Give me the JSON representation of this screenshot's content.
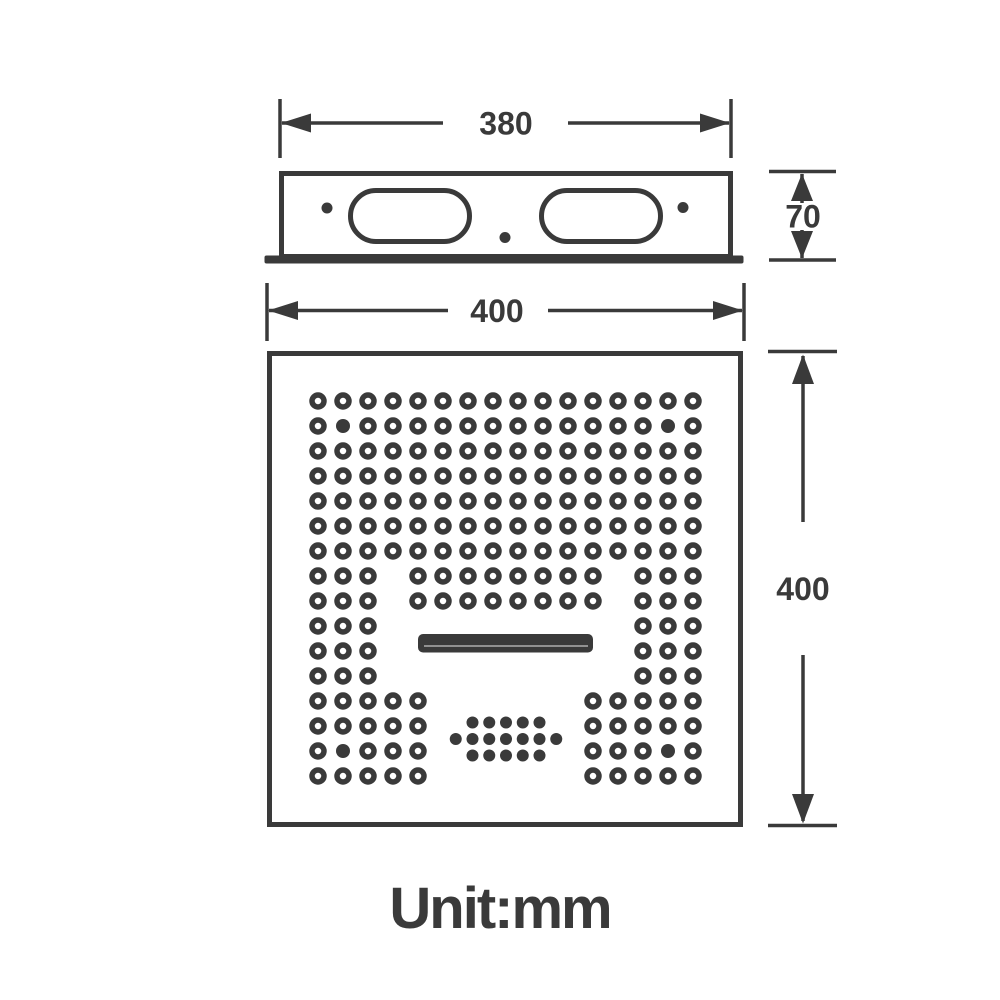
{
  "colors": {
    "ink": "#3a3a3a",
    "background": "#ffffff",
    "waterfall_highlight": "#9e9e9e"
  },
  "dimension_labels": {
    "body_width": "380",
    "body_height": "70",
    "panel_width": "400",
    "panel_height": "400"
  },
  "unit_label": "Unit:mm",
  "front_view": {
    "nozzle_grid": {
      "origin": [
        318,
        401
      ],
      "spacing": 25,
      "dot_radius": 6,
      "ring_width": 5.5,
      "solid_radius": 7,
      "rows": [
        [
          [
            1,
            16
          ]
        ],
        [
          [
            1,
            16
          ]
        ],
        [
          [
            1,
            16
          ]
        ],
        [
          [
            1,
            16
          ]
        ],
        [
          [
            1,
            16
          ]
        ],
        [
          [
            1,
            16
          ]
        ],
        [
          [
            1,
            16
          ]
        ],
        [
          [
            1,
            3
          ],
          [
            5,
            12
          ],
          [
            14,
            16
          ]
        ],
        [
          [
            1,
            3
          ],
          [
            5,
            12
          ],
          [
            14,
            16
          ]
        ],
        [
          [
            1,
            3
          ],
          [
            14,
            16
          ]
        ],
        [
          [
            1,
            3
          ],
          [
            14,
            16
          ]
        ],
        [
          [
            1,
            3
          ],
          [
            14,
            16
          ]
        ],
        [
          [
            1,
            5
          ],
          [
            12,
            16
          ]
        ],
        [
          [
            1,
            5
          ],
          [
            12,
            16
          ]
        ],
        [
          [
            1,
            5
          ],
          [
            12,
            16
          ]
        ],
        [
          [
            1,
            5
          ],
          [
            12,
            16
          ]
        ]
      ],
      "solid_dots": [
        [
          2,
          2
        ],
        [
          2,
          15
        ],
        [
          15,
          2
        ],
        [
          15,
          15
        ]
      ]
    },
    "mist_cluster": {
      "center": [
        506,
        739
      ],
      "col_spacing": 16.75,
      "row_spacing": 16.5,
      "rows": [
        5,
        7,
        5
      ],
      "dot_radius": 6
    }
  }
}
